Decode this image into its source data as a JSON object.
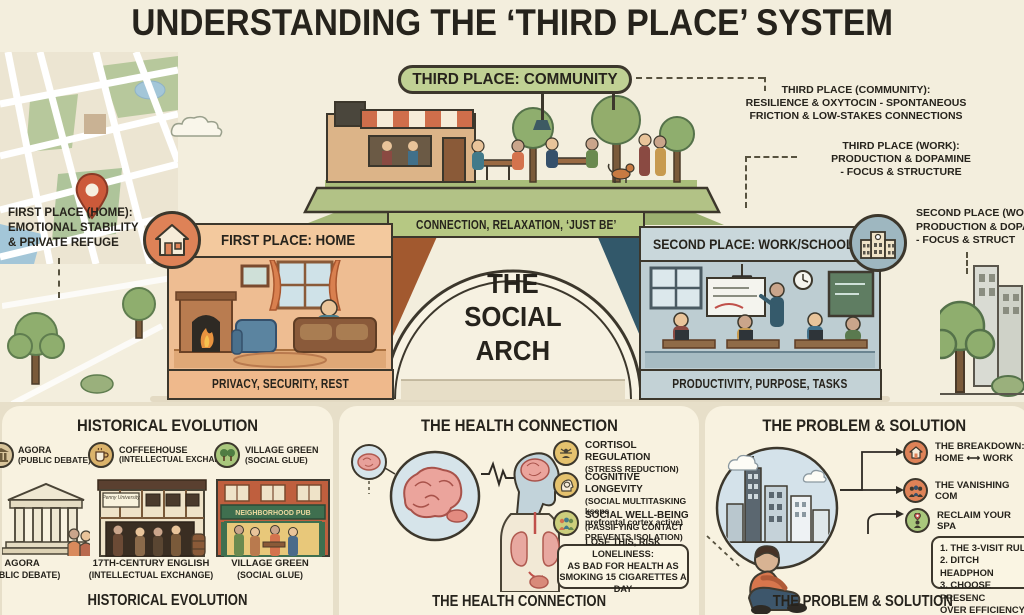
{
  "title": "UNDERSTANDING THE ‘THIRD PLACE’ SYSTEM",
  "colors": {
    "background": "#f3eedd",
    "ink": "#26231c",
    "home_orange": "#eebd92",
    "home_banner": "#efb98c",
    "work_blue": "#bdcdd2",
    "community_green": "#b6c883",
    "badge_pill_green": "#c0d194",
    "map_pin_red": "#cc5a3a",
    "icon_yellow": "#e5c26e",
    "icon_orange": "#de8257",
    "icon_green": "#a9c77c"
  },
  "arch": {
    "center_label": "THE\nSOCIAL\nARCH",
    "community": {
      "badge": "THIRD PLACE: COMMUNITY",
      "banner": "CONNECTION, RELAXATION, ‘JUST BE’"
    },
    "home": {
      "header": "FIRST PLACE: HOME",
      "banner": "PRIVACY, SECURITY, REST"
    },
    "work": {
      "header": "SECOND PLACE: WORK/SCHOOL",
      "banner": "PRODUCTIVITY, PURPOSE, TASKS"
    }
  },
  "annotations": {
    "home": "FIRST PLACE (HOME):\nEMOTIONAL STABILITY\n& PRIVATE REFUGE",
    "community": "THIRD PLACE (COMMUNITY):\nRESILIENCE & OXYTOCIN - SPONTANEOUS\nFRICTION & LOW-STAKES CONNECTIONS",
    "work": "THIRD PLACE (WORK):\nPRODUCTION & DOPAMINE\n- FOCUS & STRUCTURE",
    "second_clipped": "SECOND PLACE (WO\nPRODUCTION & DOPA\n- FOCUS & STRUCT"
  },
  "sections": {
    "historical": {
      "heading": "HISTORICAL EVOLUTION",
      "footer": "HISTORICAL EVOLUTION",
      "legend": [
        {
          "icon": "column-icon",
          "label": "AGORA",
          "sub": "(PUBLIC DEBATE)"
        },
        {
          "icon": "coffee-cup-icon",
          "label": "COFFEEHOUSE",
          "sub": "(INTELLECTUAL EXCHANGE)"
        },
        {
          "icon": "trees-icon",
          "label": "VILLAGE GREEN",
          "sub": "(SOCIAL GLUE)"
        }
      ],
      "coffeehouse_sign": "Penny University",
      "pub_sign": "NEIGHBORHOOD PUB",
      "captions": [
        {
          "label": "AGORA",
          "sub": "(PUBLIC DEBATE)"
        },
        {
          "label": "17TH-CENTURY ENGLISH",
          "sub": "(INTELLECTUAL EXCHANGE)"
        },
        {
          "label": "VILLAGE GREEN",
          "sub": "(SOCIAL GLUE)"
        }
      ]
    },
    "health": {
      "heading": "THE HEALTH CONNECTION",
      "footer": "THE HEALTH CONNECTION",
      "items": [
        {
          "icon": "stress-relief-icon",
          "title": "CORTISOL REGULATION",
          "sub": "(STRESS REDUCTION)"
        },
        {
          "icon": "brain-head-icon",
          "title": "COGNITIVE LONGEVITY",
          "sub": "(SOCIAL MULTITASKING kseps\nprefrontal cortex active)"
        },
        {
          "icon": "people-group-icon",
          "title": "SOCIAL WELL-BEING",
          "sub": "(PASSIFYING CONTACT\nPREVENTS ISOLATION)"
        }
      ],
      "warning": "LOSE THIS, RISK LONELINESS:\nAS BAD FOR HEALTH AS\nSMOKING 15 CIGARETTES A DAY"
    },
    "problem": {
      "heading": "THE PROBLEM & SOLUTION",
      "footer": "THE PROBLEM & SOLUTION",
      "items": [
        {
          "icon": "house-icon",
          "title": "THE BREAKDOWN:",
          "sub": "HOME ⟷ WORK"
        },
        {
          "icon": "people-group-icon",
          "title": "THE VANISHING COM",
          "sub": ""
        },
        {
          "icon": "reclaim-pin-icon",
          "title": "RECLAIM YOUR SPA",
          "sub": ""
        }
      ],
      "solution": "1. THE 3-VISIT RULE\n2. DITCH HEADPHON\n3. CHOOSE PRESENC\n    OVER EFFICIENCY"
    }
  }
}
